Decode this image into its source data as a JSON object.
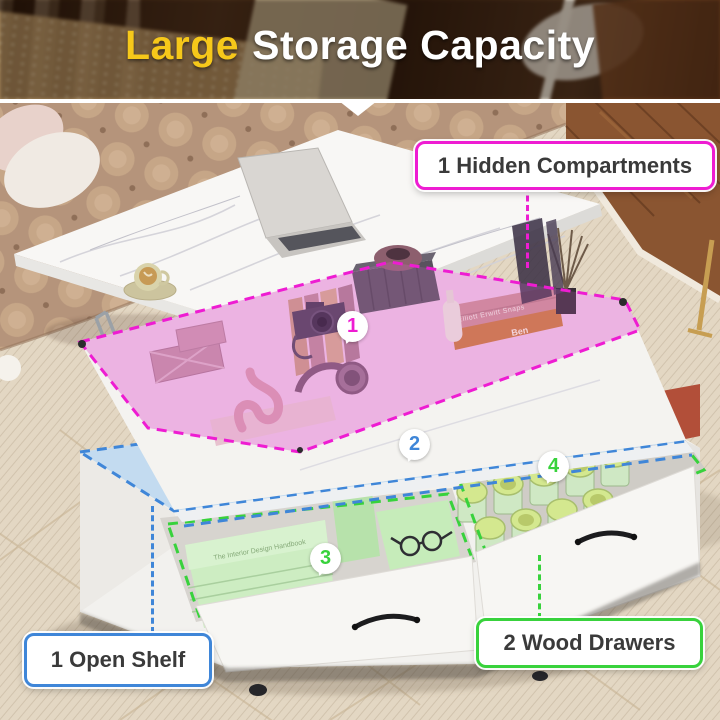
{
  "banner": {
    "title_highlight": "Large",
    "title_rest": "Storage Capacity"
  },
  "annotations": {
    "hidden_compartments": {
      "label": "1 Hidden Compartments",
      "badge": "1"
    },
    "open_shelf": {
      "label": "1 Open Shelf",
      "badge": "2"
    },
    "wood_drawers": {
      "label": "2 Wood Drawers",
      "badge_left": "3",
      "badge_right": "4"
    }
  },
  "scene_text": {
    "book_spine_1": "Elliott Erwitt Snaps",
    "book_spine_2": "Ben",
    "shelf_book_cover": "The Interior Design Handbook"
  },
  "theme": {
    "accent_pink": "#ee1cd2",
    "accent_blue": "#3f86d8",
    "accent_green": "#38d23c",
    "banner_yellow": "#f6c81a",
    "banner_white": "#ffffff",
    "label_text": "#3a3a3a",
    "overlay_pink": "#f0b9e3",
    "overlay_blue": "#c3dbf0",
    "overlay_green": "#bfe6b4"
  }
}
